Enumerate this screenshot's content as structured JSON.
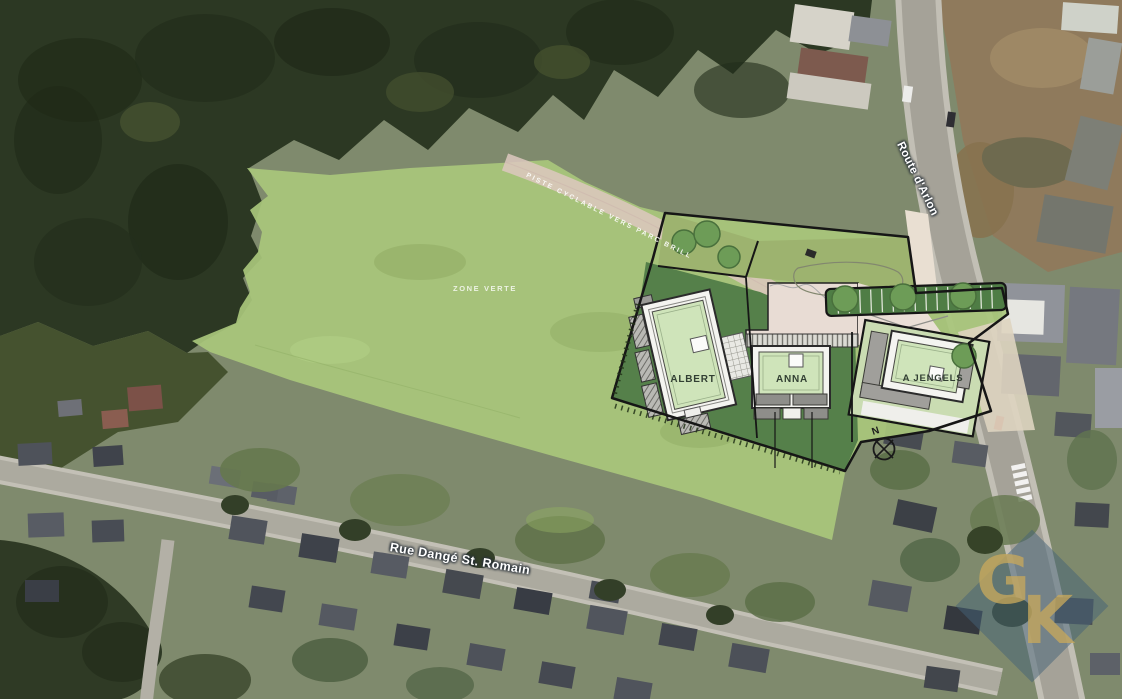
{
  "map": {
    "area_label": "ZONE VERTE",
    "path_label": "PISTE CYCLABLE VERS PARC BRILL",
    "streets": [
      {
        "name": "Rue Dangé St. Romain"
      },
      {
        "name": "Route d'Arlon"
      }
    ],
    "buildings": [
      {
        "name": "ALBERT"
      },
      {
        "name": "ANNA"
      },
      {
        "name": "A JENGELS"
      }
    ],
    "compass": {
      "north_label": "N"
    },
    "watermark": {
      "letter_g": "G",
      "letter_k": "K"
    },
    "colors": {
      "zone_verte_green": "#a9c77c",
      "plan_garden_green": "#55804a",
      "building_roof_green": "#cfe4ba",
      "path_pink": "#ddc8c0",
      "parking_green": "#4f7d45",
      "tree_green": "#6d9c57",
      "street_label_text": "#ffffff",
      "building_label_text": "#323f33",
      "watermark_blue": "rgba(68,98,120,0.5)",
      "watermark_gold": "rgba(198,168,92,0.78)"
    }
  }
}
